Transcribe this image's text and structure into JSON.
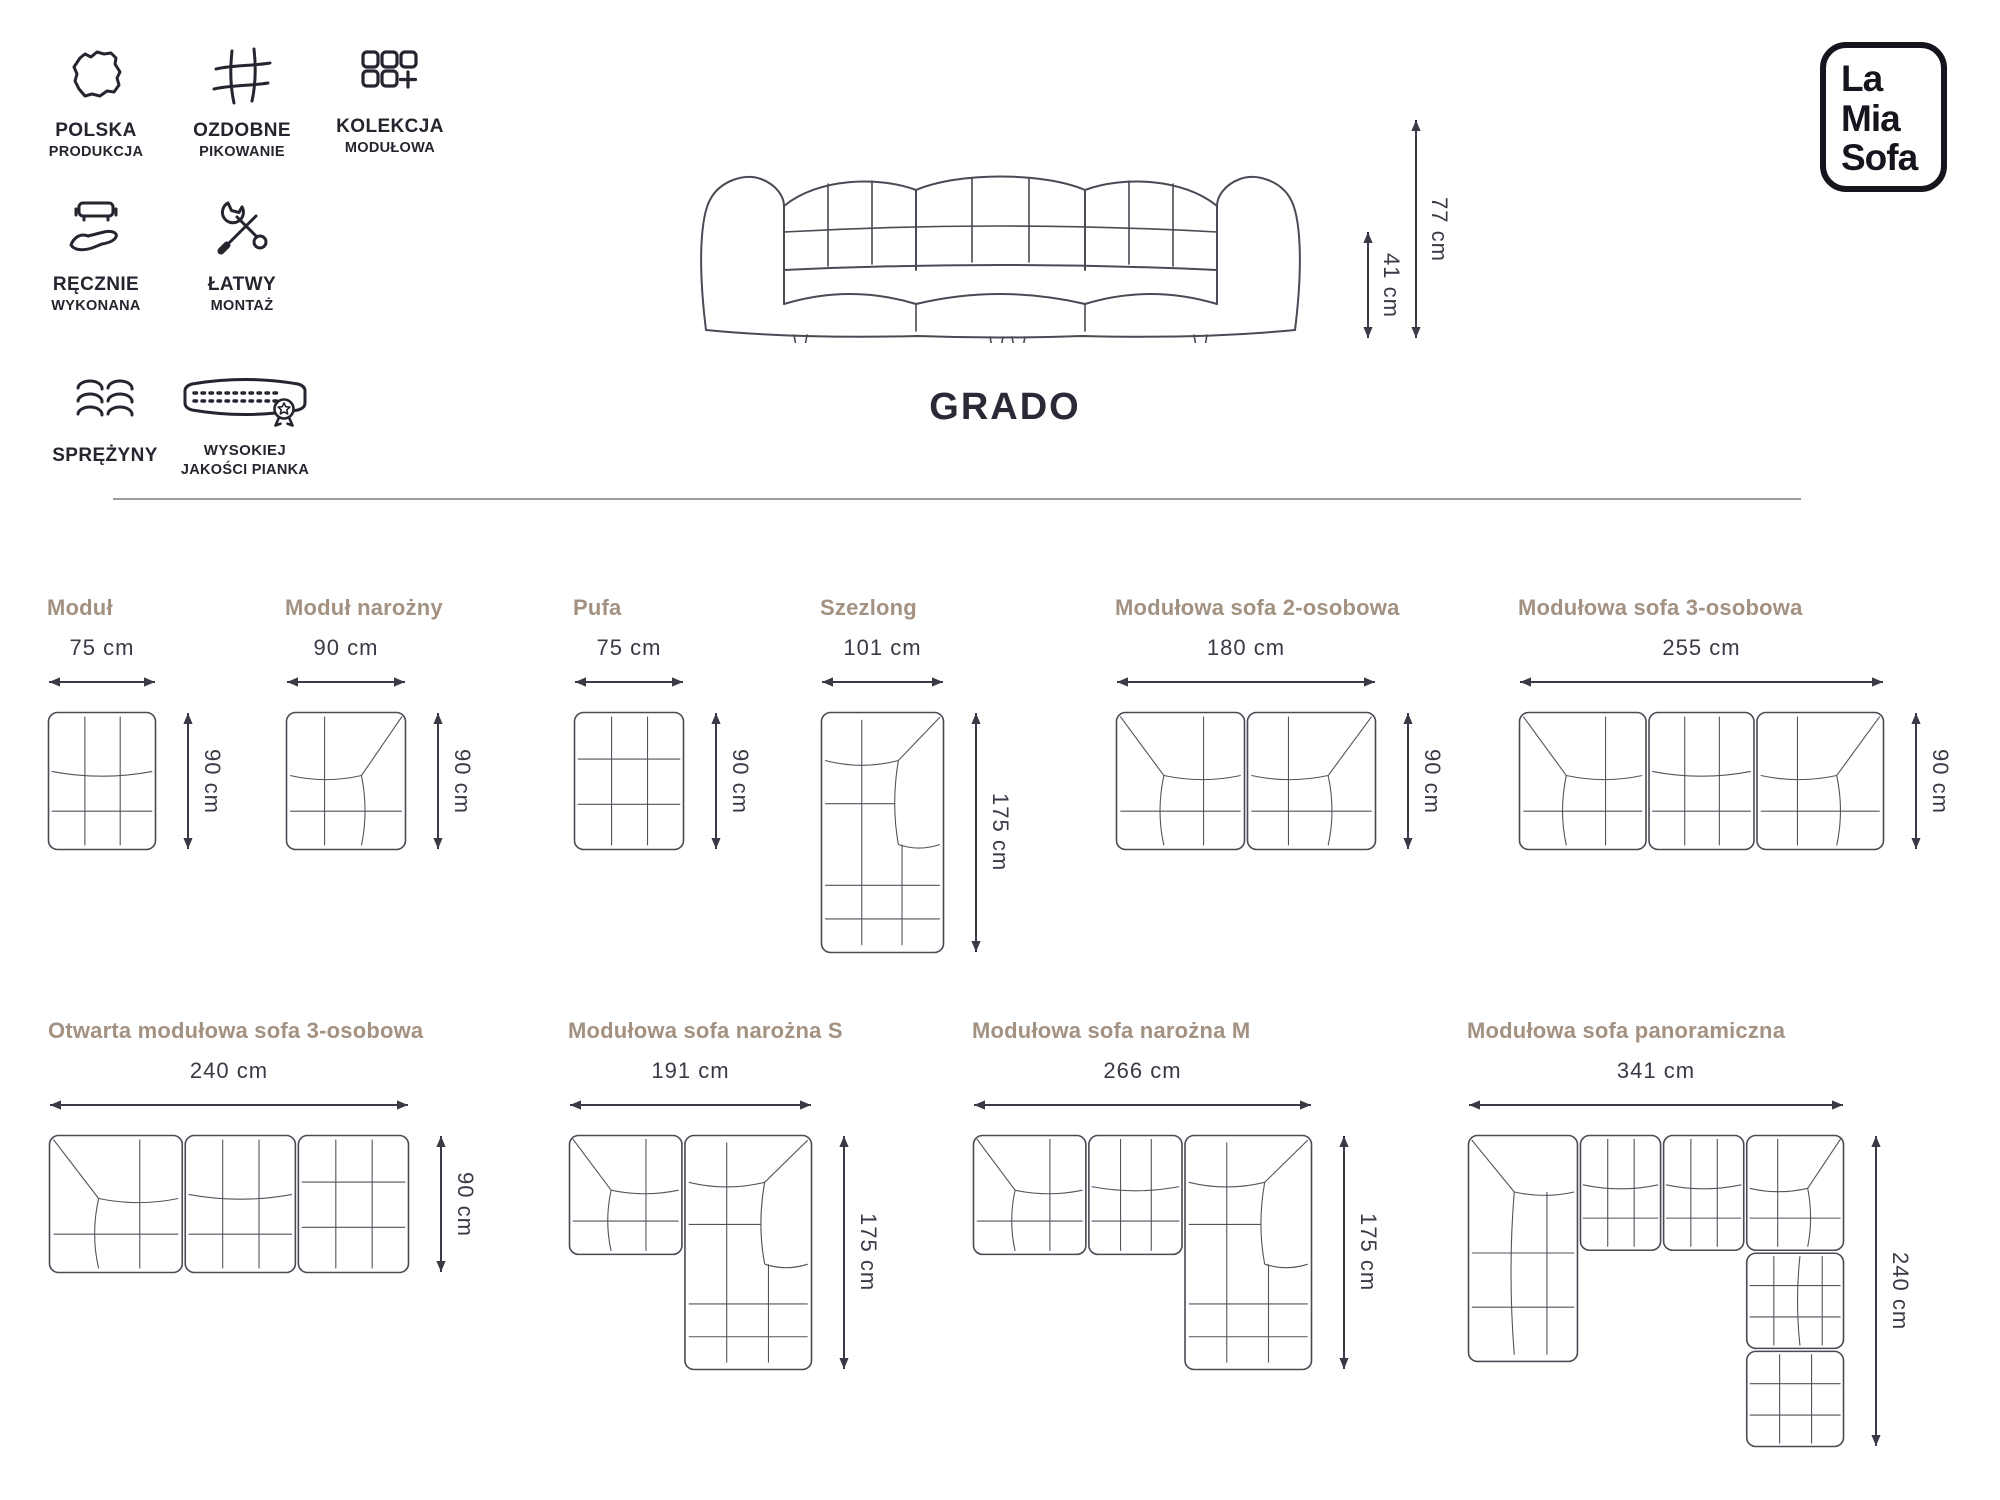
{
  "logo": {
    "lines": [
      "La",
      "Mia",
      "Sofa"
    ]
  },
  "hero": {
    "product_name": "GRADO",
    "overall_height_label": "77 cm",
    "seat_height_label": "41 cm"
  },
  "badges": [
    {
      "icon": "poland-map",
      "line1": "POLSKA",
      "line2": "PRODUKCJA"
    },
    {
      "icon": "quilting-grid",
      "line1": "OZDOBNE",
      "line2": "PIKOWANIE"
    },
    {
      "icon": "modular-squares",
      "line1": "KOLEKCJA",
      "line2": "MODUŁOWA"
    },
    {
      "icon": "hand-sofa",
      "line1": "RĘCZNIE",
      "line2": "WYKONANA"
    },
    {
      "icon": "tools",
      "line1": "ŁATWY",
      "line2": "MONTAŻ"
    },
    {
      "icon": "springs",
      "line1": "SPRĘŻYNY",
      "line2": ""
    },
    {
      "icon": "foam-award",
      "line1": "WYSOKIEJ",
      "line2": "JAKOŚCI PIANKA"
    }
  ],
  "colors": {
    "title": "#a39182",
    "ink": "#26242e",
    "dimension": "#3b3946",
    "line": "#55525c",
    "outline": "#4b4954",
    "divider": "#9c9c9c"
  },
  "configs": [
    {
      "title": "Moduł",
      "width_label": "75 cm",
      "height_label": "90 cm",
      "box": {
        "w": 75,
        "h": 90
      },
      "blocks": [
        {
          "type": "module",
          "x": 0,
          "y": 0,
          "w": 75,
          "h": 90
        }
      ]
    },
    {
      "title": "Moduł narożny",
      "width_label": "90 cm",
      "height_label": "90 cm",
      "box": {
        "w": 90,
        "h": 90
      },
      "blocks": [
        {
          "type": "corner-r",
          "x": 0,
          "y": 0,
          "w": 90,
          "h": 90
        }
      ]
    },
    {
      "title": "Pufa",
      "width_label": "75 cm",
      "height_label": "90 cm",
      "box": {
        "w": 75,
        "h": 90
      },
      "blocks": [
        {
          "type": "pufa",
          "x": 0,
          "y": 0,
          "w": 75,
          "h": 90
        }
      ]
    },
    {
      "title": "Szezlong",
      "width_label": "101 cm",
      "height_label": "175 cm",
      "box": {
        "w": 101,
        "h": 175
      },
      "blocks": [
        {
          "type": "szezlong-r",
          "x": 0,
          "y": 0,
          "w": 101,
          "h": 175
        }
      ]
    },
    {
      "title": "Modułowa sofa 2-osobowa",
      "width_label": "180 cm",
      "height_label": "90 cm",
      "box": {
        "w": 180,
        "h": 90
      },
      "blocks": [
        {
          "type": "corner-l",
          "x": 0,
          "y": 0,
          "w": 90,
          "h": 90
        },
        {
          "type": "corner-r",
          "x": 90,
          "y": 0,
          "w": 90,
          "h": 90
        }
      ]
    },
    {
      "title": "Modułowa sofa 3-osobowa",
      "width_label": "255 cm",
      "height_label": "90 cm",
      "box": {
        "w": 255,
        "h": 90
      },
      "blocks": [
        {
          "type": "corner-l",
          "x": 0,
          "y": 0,
          "w": 90,
          "h": 90
        },
        {
          "type": "module",
          "x": 90,
          "y": 0,
          "w": 75,
          "h": 90
        },
        {
          "type": "corner-r",
          "x": 165,
          "y": 0,
          "w": 90,
          "h": 90
        }
      ]
    },
    {
      "title": "Otwarta modułowa sofa 3-osobowa",
      "width_label": "240 cm",
      "height_label": "90 cm",
      "box": {
        "w": 240,
        "h": 90
      },
      "blocks": [
        {
          "type": "corner-l",
          "x": 0,
          "y": 0,
          "w": 90,
          "h": 90
        },
        {
          "type": "module",
          "x": 90,
          "y": 0,
          "w": 75,
          "h": 90
        },
        {
          "type": "pufa",
          "x": 165,
          "y": 0,
          "w": 75,
          "h": 90
        }
      ]
    },
    {
      "title": "Modułowa sofa narożna S",
      "width_label": "191 cm",
      "height_label": "175 cm",
      "box": {
        "w": 191,
        "h": 175
      },
      "blocks": [
        {
          "type": "corner-l",
          "x": 0,
          "y": 0,
          "w": 90,
          "h": 90
        },
        {
          "type": "szezlong-r",
          "x": 90,
          "y": 0,
          "w": 101,
          "h": 175
        }
      ]
    },
    {
      "title": "Modułowa sofa narożna M",
      "width_label": "266 cm",
      "height_label": "175 cm",
      "box": {
        "w": 266,
        "h": 175
      },
      "blocks": [
        {
          "type": "corner-l",
          "x": 0,
          "y": 0,
          "w": 90,
          "h": 90
        },
        {
          "type": "module",
          "x": 90,
          "y": 0,
          "w": 75,
          "h": 90
        },
        {
          "type": "szezlong-r",
          "x": 165,
          "y": 0,
          "w": 101,
          "h": 175
        }
      ]
    },
    {
      "title": "Modułowa sofa panoramiczna",
      "width_label": "341 cm",
      "height_label": "240 cm",
      "box": {
        "w": 341,
        "h": 240
      },
      "blocks": [
        {
          "type": "szezlong-vert-l",
          "x": 0,
          "y": 0,
          "w": 101,
          "h": 175
        },
        {
          "type": "module",
          "x": 101,
          "y": 0,
          "w": 75,
          "h": 90
        },
        {
          "type": "module",
          "x": 176,
          "y": 0,
          "w": 75,
          "h": 90
        },
        {
          "type": "corner-r",
          "x": 251,
          "y": 0,
          "w": 90,
          "h": 90
        },
        {
          "type": "module-vert",
          "x": 251,
          "y": 90,
          "w": 90,
          "h": 75
        },
        {
          "type": "pufa",
          "x": 251,
          "y": 165,
          "w": 90,
          "h": 75
        }
      ]
    }
  ]
}
